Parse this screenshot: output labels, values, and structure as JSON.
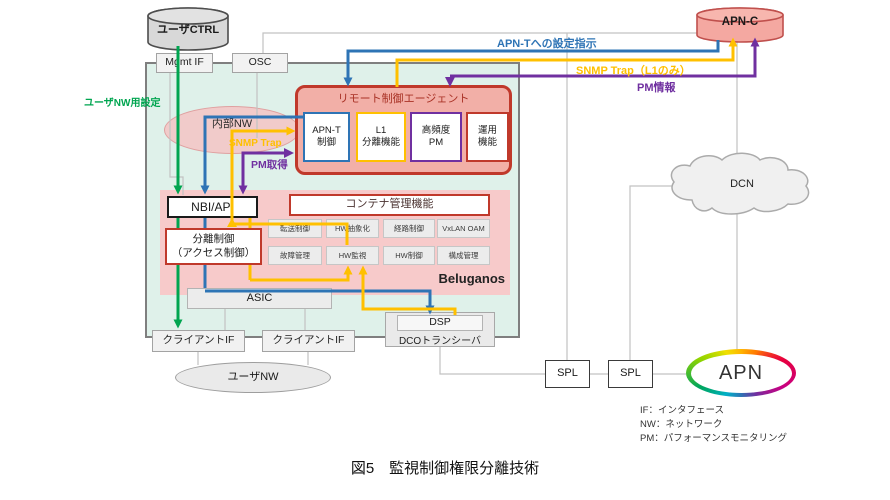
{
  "accent_colors": {
    "green": "#00A550",
    "blue": "#2E74B5",
    "yellow": "#FFC000",
    "purple": "#7030A0",
    "agent_fill": "#F2AFA7",
    "agent_border": "#C0392B",
    "device_fill": "#DFF1EA",
    "beluganos_fill": "#F7CACA",
    "apn_c_fill": "#F4A8A1"
  },
  "nodes": {
    "user_ctrl": {
      "label": "ユーザCTRL"
    },
    "apn_c": {
      "label": "APN-C"
    },
    "mgmt_if": {
      "label": "Mgmt IF"
    },
    "osc": {
      "label": "OSC"
    },
    "internal_nw": {
      "label": "内部NW"
    },
    "agent": {
      "title": "リモート制御エージェント",
      "modules": [
        {
          "label": "APN-T\n制御",
          "border": "#2E74B5"
        },
        {
          "label": "L1\n分離機能",
          "border": "#FFC000"
        },
        {
          "label": "高頻度\nPM",
          "border": "#7030A0"
        },
        {
          "label": "運用\n機能",
          "border": "#C0392B"
        }
      ]
    },
    "nbi_api": {
      "label": "NBI/API"
    },
    "container_mgmt": {
      "label": "コンテナ管理機能"
    },
    "separation_ctrl": {
      "label": "分離制御\n（アクセス制御）"
    },
    "beluganos": {
      "label": "Beluganos",
      "modules": [
        "転送制御",
        "HW抽象化",
        "経路制御",
        "VxLAN OAM",
        "故障管理",
        "HW監視",
        "HW制御",
        "構成管理"
      ]
    },
    "asic": {
      "label": "ASIC"
    },
    "dsp": {
      "label": "DSP"
    },
    "dco": {
      "label": "DCOトランシーバ"
    },
    "client_if": {
      "label": "クライアントIF"
    },
    "user_nw": {
      "label": "ユーザNW"
    },
    "spl": {
      "label": "SPL"
    },
    "dcn": {
      "label": "DCN"
    },
    "apn": {
      "label": "APN"
    }
  },
  "flow_labels": {
    "apn_t_config": "APN-Tへの設定指示",
    "snmp_trap_l1": "SNMP Trap（L1のみ）",
    "pm_info": "PM情報",
    "user_nw_config": "ユーザNW用設定",
    "snmp_trap": "SNMP Trap",
    "pm_get": "PM取得"
  },
  "legend": {
    "line1": "IF：インタフェース",
    "line2": "NW：ネットワーク",
    "line3": "PM：パフォーマンスモニタリング"
  },
  "caption": "図5　監視制御権限分離技術"
}
